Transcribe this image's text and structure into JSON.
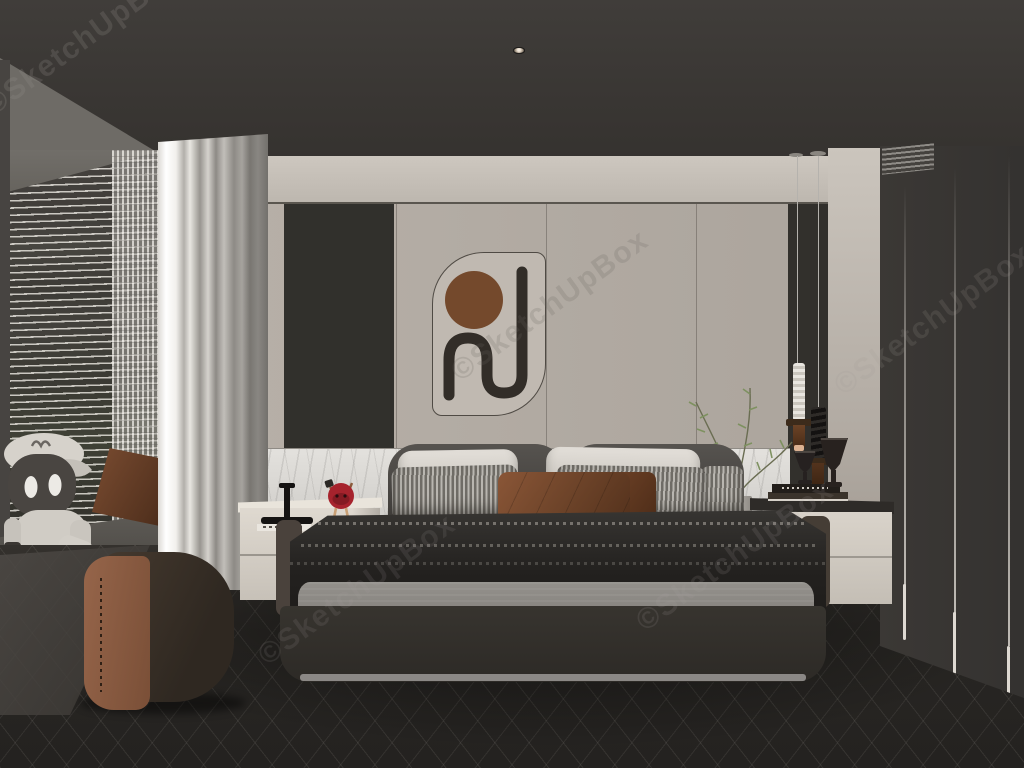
{
  "scene": {
    "type": "3d-interior-render",
    "room": "modern-bedroom",
    "watermark": {
      "text": "©SketchUpBox"
    },
    "ceiling": {
      "light_count": 5
    },
    "palette": {
      "ceiling": "#3a3734",
      "wall_beige": "#b3aca4",
      "soffit": "#c9c3bb",
      "accent_panel": "#31302c",
      "marble": "#d7d5d1",
      "curtain": "#f0eeea",
      "headboard": "#4b4946",
      "duvet": "#272523",
      "blanket_gray": "#8f8c88",
      "pillow_brown": "#7c4e33",
      "nightstand_cream": "#d5cfc6",
      "ottoman_brown": "#8a5a3e",
      "wardrobe": "#393632",
      "floor": "#2b2927",
      "art_circle_brown": "#74492c",
      "art_stroke_dark": "#322d28",
      "plant_green": "#7e9160",
      "figurine_red": "#a6232d",
      "pendant_brass": "#5d3b22"
    },
    "objects": [
      "recessed-ceiling-lights",
      "wall-art-panel",
      "pendant-light-white",
      "pendant-light-black",
      "window-blinds",
      "sheer-curtain",
      "curtain",
      "sill-robot-figure",
      "sill-cushion",
      "bed",
      "headboard",
      "pillows",
      "knit-duvet",
      "gray-blanket",
      "bed-frame",
      "nightstand-left",
      "table-lamp",
      "mnm-figurine",
      "books",
      "nightstand-right",
      "goblet-vases",
      "plant-branch",
      "leather-ottoman",
      "wardrobe",
      "herringbone-floor",
      "marble-wainscot"
    ]
  }
}
